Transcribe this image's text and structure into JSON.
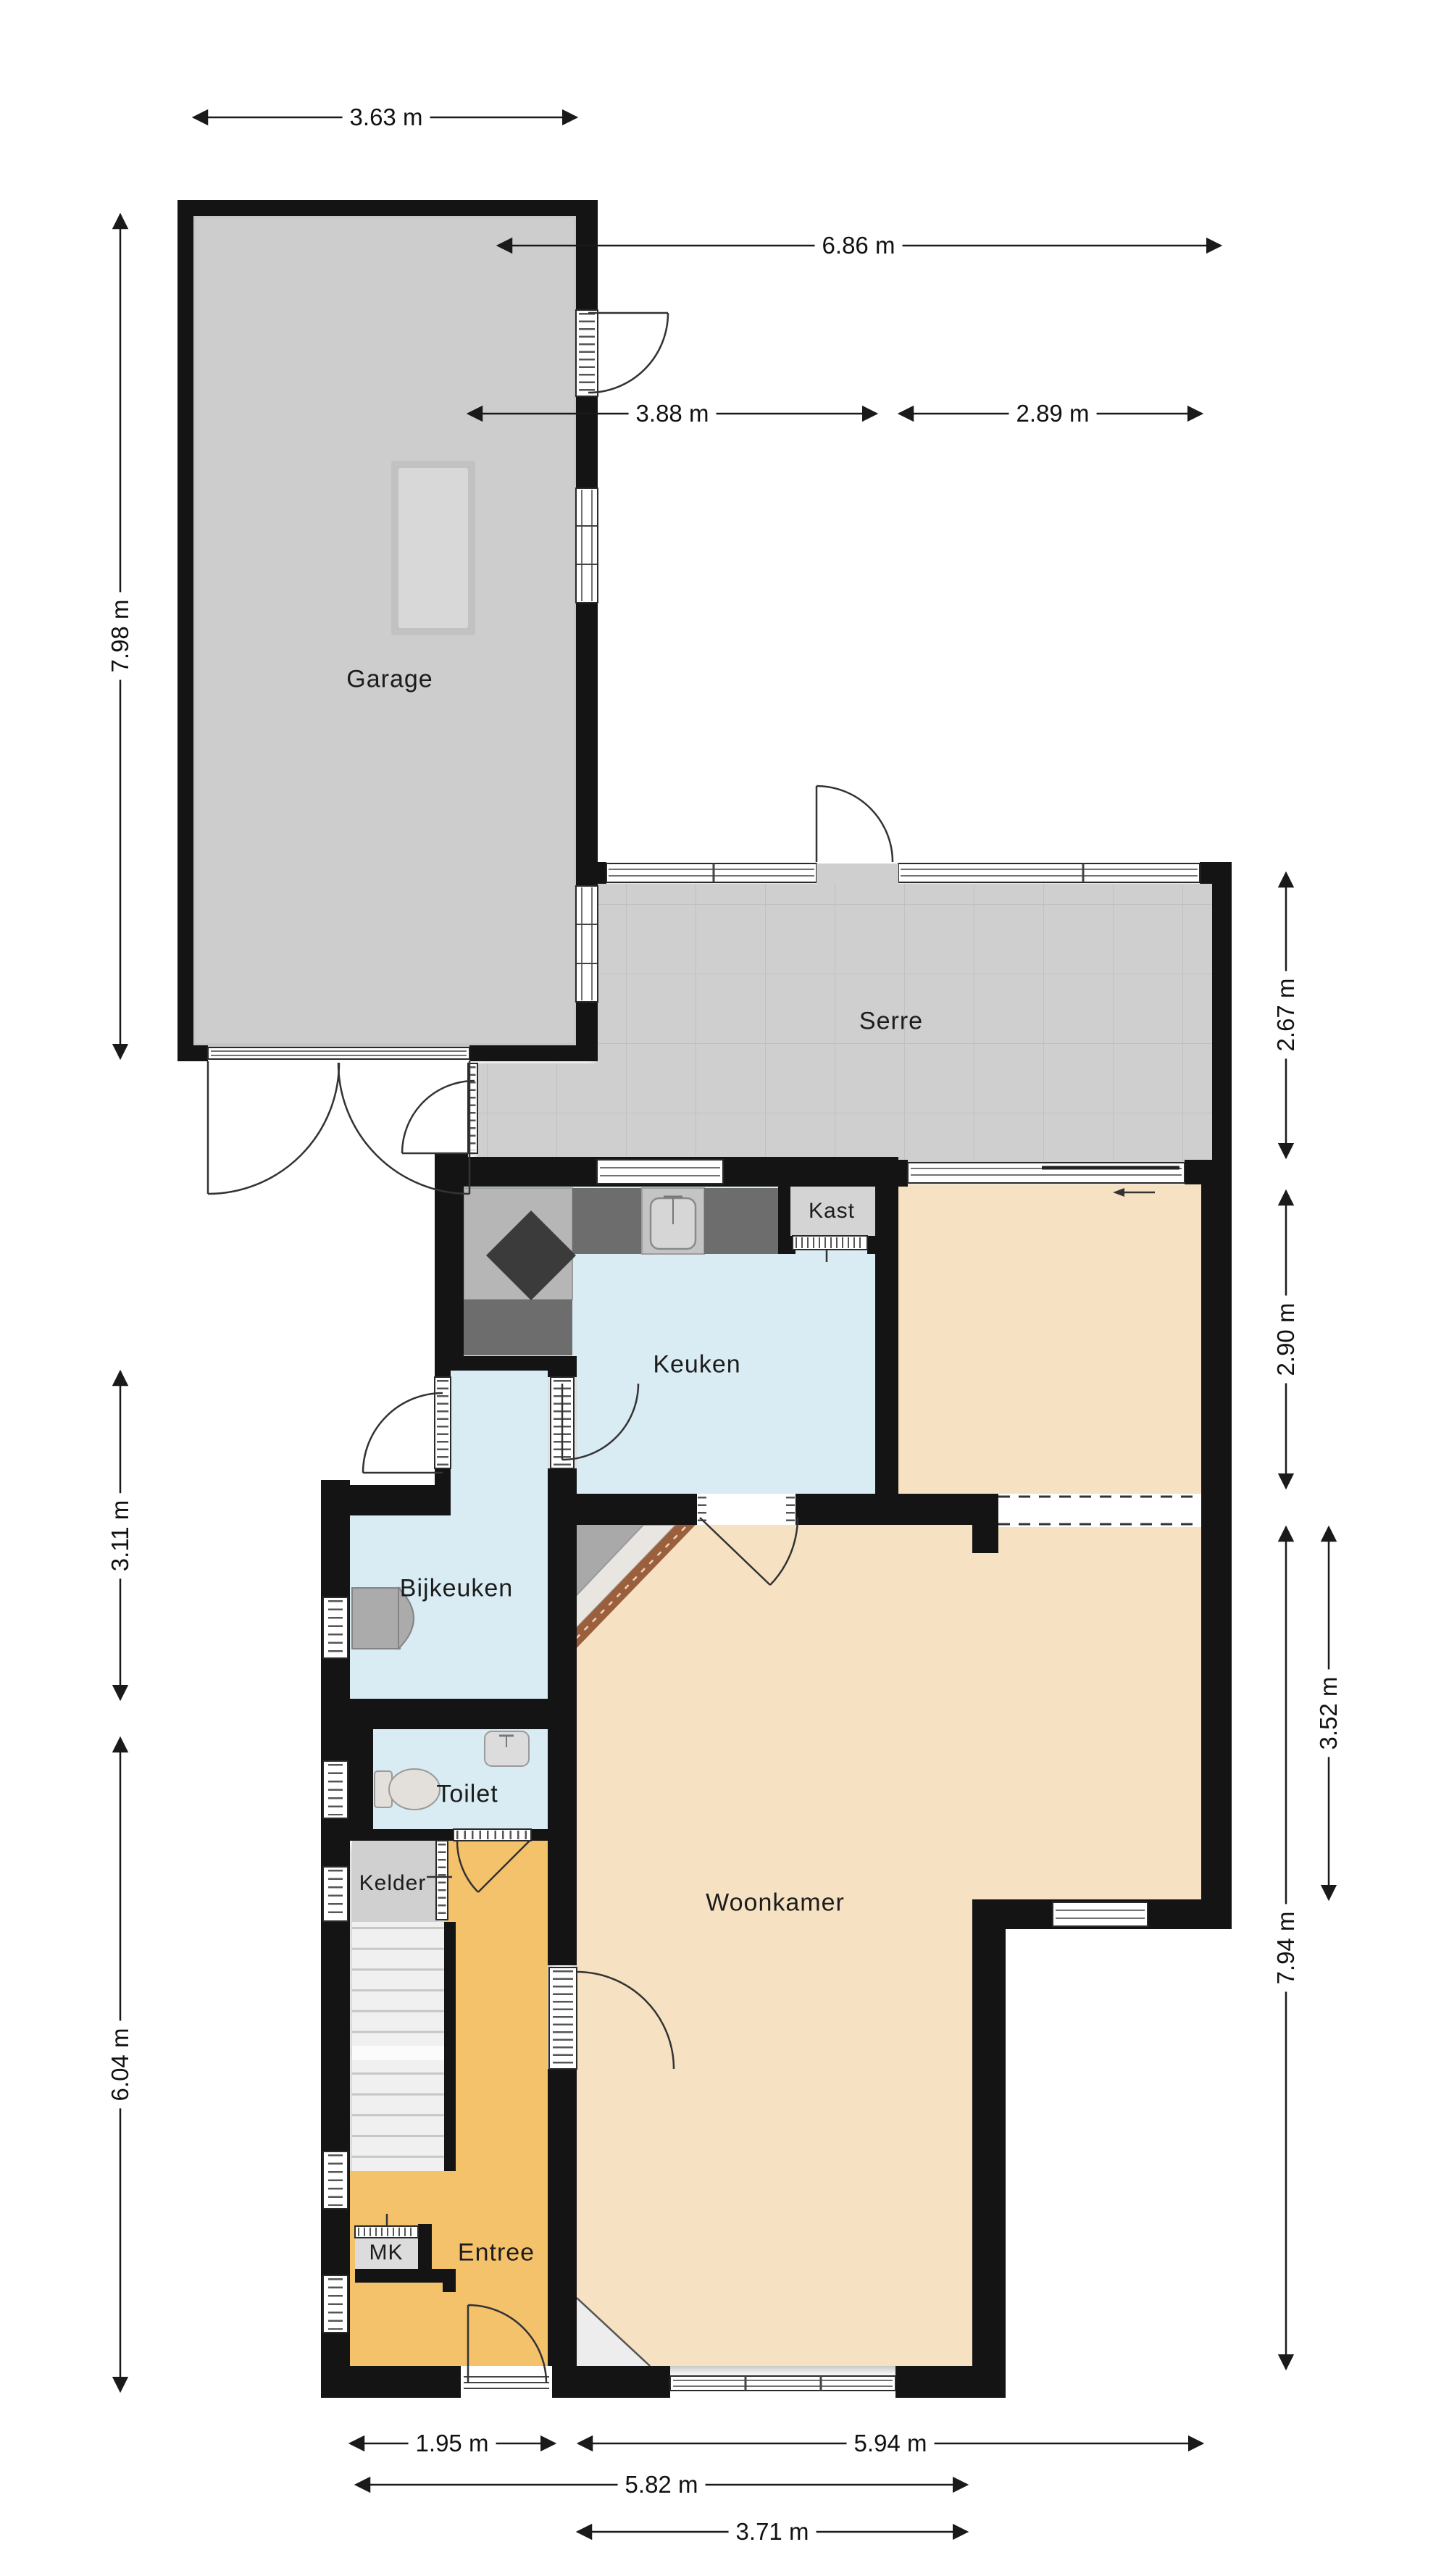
{
  "plan_title": "",
  "colors": {
    "bg": "#ffffff",
    "wall": "#141414",
    "garage-floor": "#cdcdcd",
    "serre-floor": "#cfcfcf",
    "tile-line": "#c1c1c1",
    "wet-floor": "#d9ecf3",
    "living-floor": "#f6e2c3",
    "hall-floor": "#f5c26c",
    "closet-floor": "#d4d4d4",
    "counter": "#b6b6b6",
    "counter-dark": "#6d6d6d",
    "stove": "#3b3b3b",
    "appliance": "#ababab",
    "fixture": "#e3dfda",
    "brick": "#9b5f3c",
    "line": "#2a2a2a",
    "dimline": "#1a1a1a"
  },
  "rooms": {
    "garage": {
      "label": "Garage"
    },
    "serre": {
      "label": "Serre"
    },
    "keuken": {
      "label": "Keuken"
    },
    "kast": {
      "label": "Kast"
    },
    "bijkeuken": {
      "label": "Bijkeuken"
    },
    "toilet": {
      "label": "Toilet"
    },
    "kelder": {
      "label": "Kelder"
    },
    "entree": {
      "label": "Entree"
    },
    "mk": {
      "label": "MK"
    },
    "woonkamer": {
      "label": "Woonkamer"
    }
  },
  "dimensions": {
    "top": [
      {
        "label": "3.63 m"
      },
      {
        "label": "6.86 m"
      },
      {
        "label": "3.88 m"
      },
      {
        "label": "2.89 m"
      }
    ],
    "left": [
      {
        "label": "7.98 m"
      },
      {
        "label": "3.11 m"
      },
      {
        "label": "6.04 m"
      }
    ],
    "right": [
      {
        "label": "2.67 m"
      },
      {
        "label": "2.90 m"
      },
      {
        "label": "3.52 m"
      },
      {
        "label": "7.94 m"
      }
    ],
    "bottom": [
      {
        "label": "1.95 m"
      },
      {
        "label": "5.94 m"
      },
      {
        "label": "5.82 m"
      },
      {
        "label": "3.71 m"
      }
    ]
  }
}
